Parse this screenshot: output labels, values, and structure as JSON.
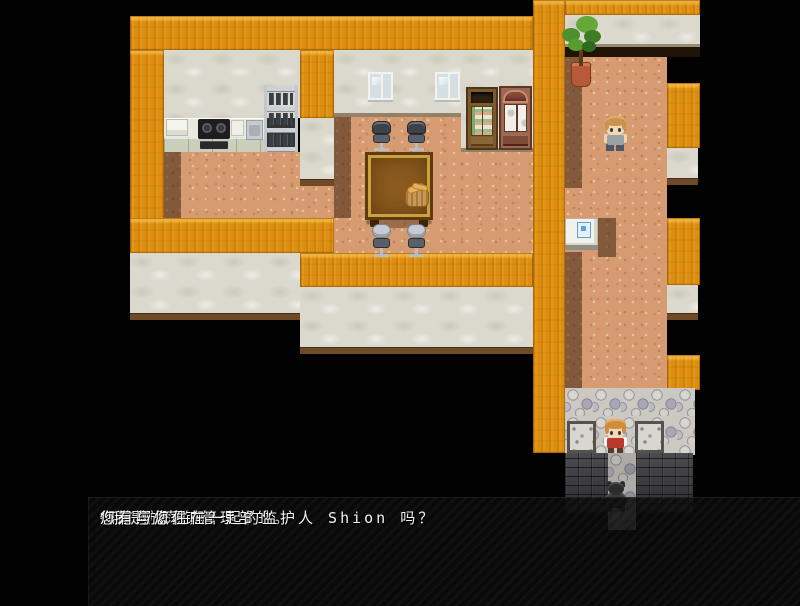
{
  "scene": {
    "description": "RPG top-down interior map with kitchen, dining room, corridor and stone entry",
    "colors": {
      "wall_top": "#dd8e10",
      "wall_face": "#dbd8ce",
      "floor": "#d69b71",
      "floor_shadow": "#6a4a30",
      "cobblestone": "#ccc9c3",
      "brick": "#3a3a3d",
      "background": "#020202",
      "dialog_background": "rgba(10,10,10,0.87)",
      "dialog_text": "#f2f2f2"
    },
    "characters": [
      {
        "id": "npc-child",
        "hair": "#c9924e",
        "top": "#9aa2a6",
        "bottom": "#505668"
      },
      {
        "id": "player-girl",
        "hair": "#cf8c3c",
        "top": "#b73a2c"
      },
      {
        "id": "dark-dog",
        "body": "#3a3a3d"
      }
    ]
  },
  "dialog": {
    "speaker": "行政人员",
    "lines": [
      "“我是放荡镇管理部的。",
      "你是翔太君吗？",
      "您有与您住在一起的监护人 Shion 吗？"
    ]
  }
}
